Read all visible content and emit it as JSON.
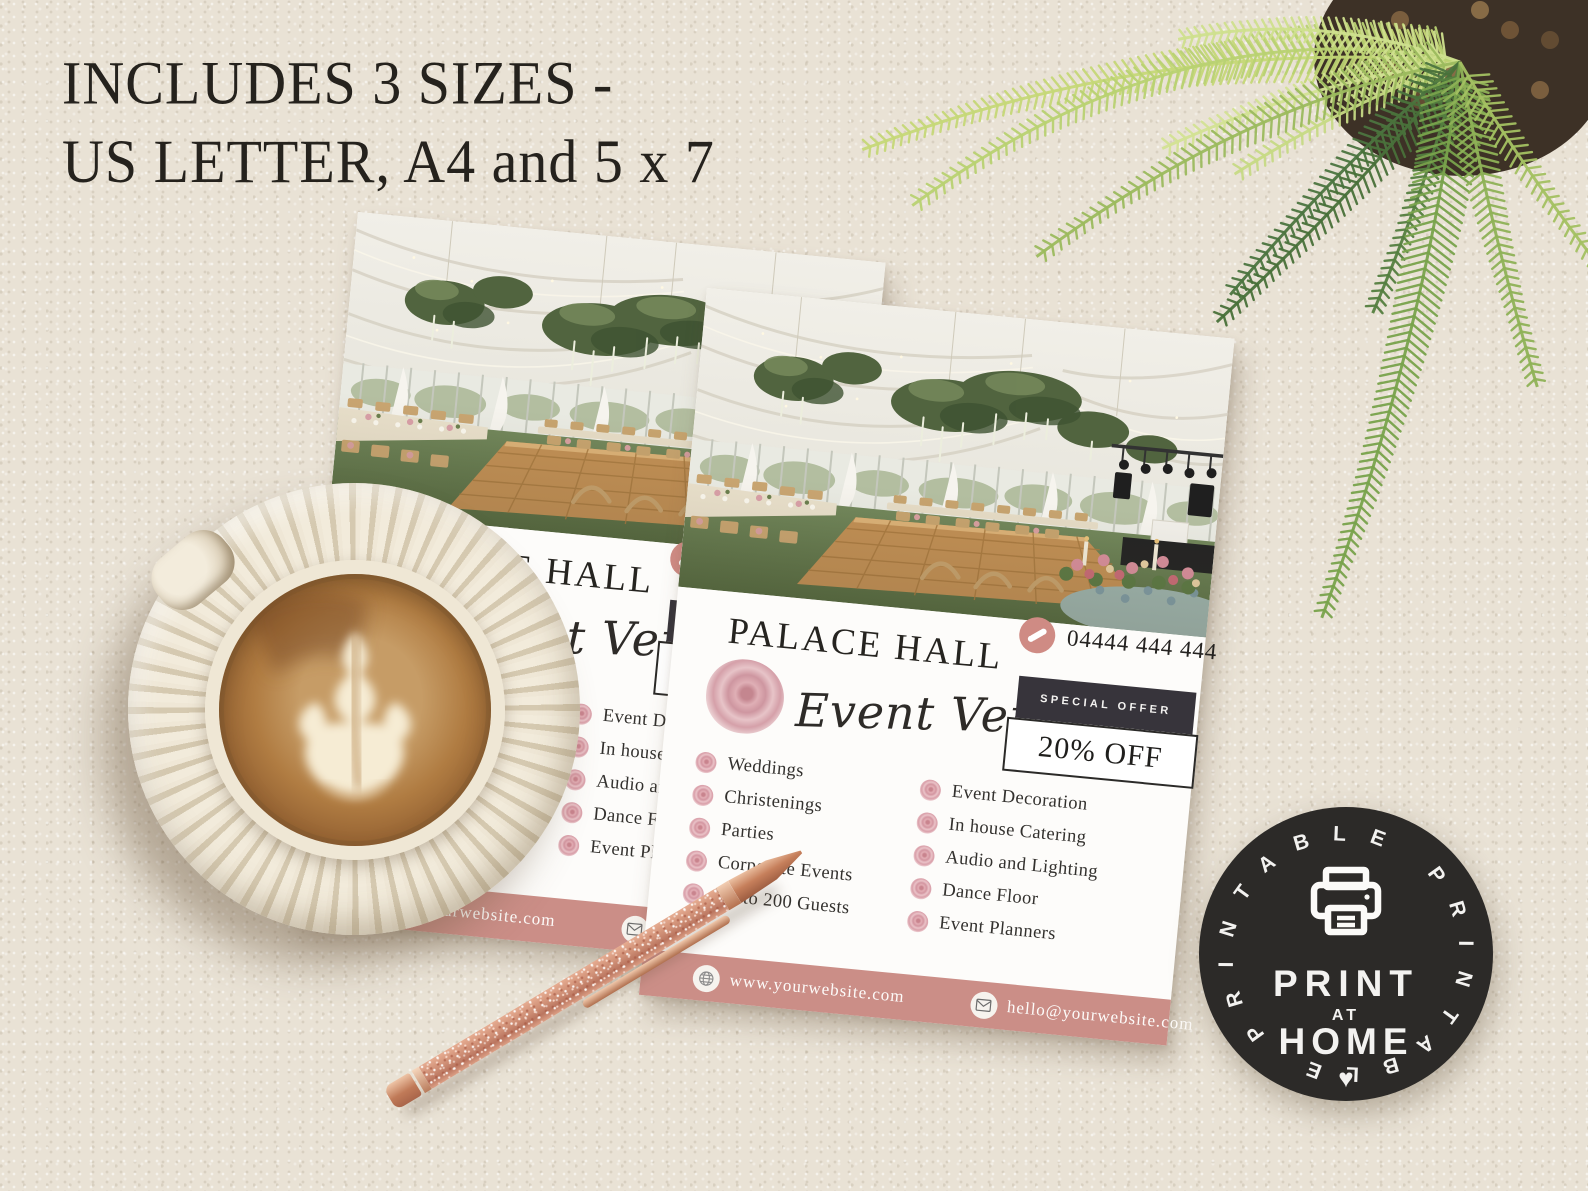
{
  "scene": {
    "heading_line1": "INCLUDES 3 SIZES -",
    "heading_line2": "US LETTER, A4 and 5 x 7"
  },
  "flyer": {
    "title": "PALACE HALL",
    "subtitle_script": "Event Venue",
    "phone": "04444 444 444",
    "offer_label": "SPECIAL OFFER",
    "offer_value": "20% OFF",
    "services_left": [
      "Weddings",
      "Christenings",
      "Parties",
      "Corporate Events",
      "Up to 200 Guests"
    ],
    "services_right": [
      "Event Decoration",
      "In house Catering",
      "Audio and Lighting",
      "Dance Floor",
      "Event Planners"
    ],
    "website": "www.yourwebsite.com",
    "email": "hello@yourwebsite.com"
  },
  "badge": {
    "ring_text": "PRINTABLE PRINTABLE",
    "line1": "PRINT",
    "line2": "AT",
    "line3": "HOME",
    "heart_glyph": "♥"
  },
  "icons": {
    "phone": "phone-handset-icon",
    "globe": "globe-icon",
    "email": "envelope-icon",
    "printer": "printer-icon",
    "heart": "heart-icon",
    "bullet": "rose-icon"
  },
  "colors": {
    "background": "#e9e2d5",
    "flyer-white": "#fdfcfa",
    "rose-bar": "#cb8e87",
    "charcoal": "#37343b",
    "badge-black": "#2c2a28",
    "text-dark": "#262420",
    "rose-pink": "#dcaab0",
    "pen-rose-gold": "#d0927b",
    "fern-green": "#7ca64f"
  }
}
